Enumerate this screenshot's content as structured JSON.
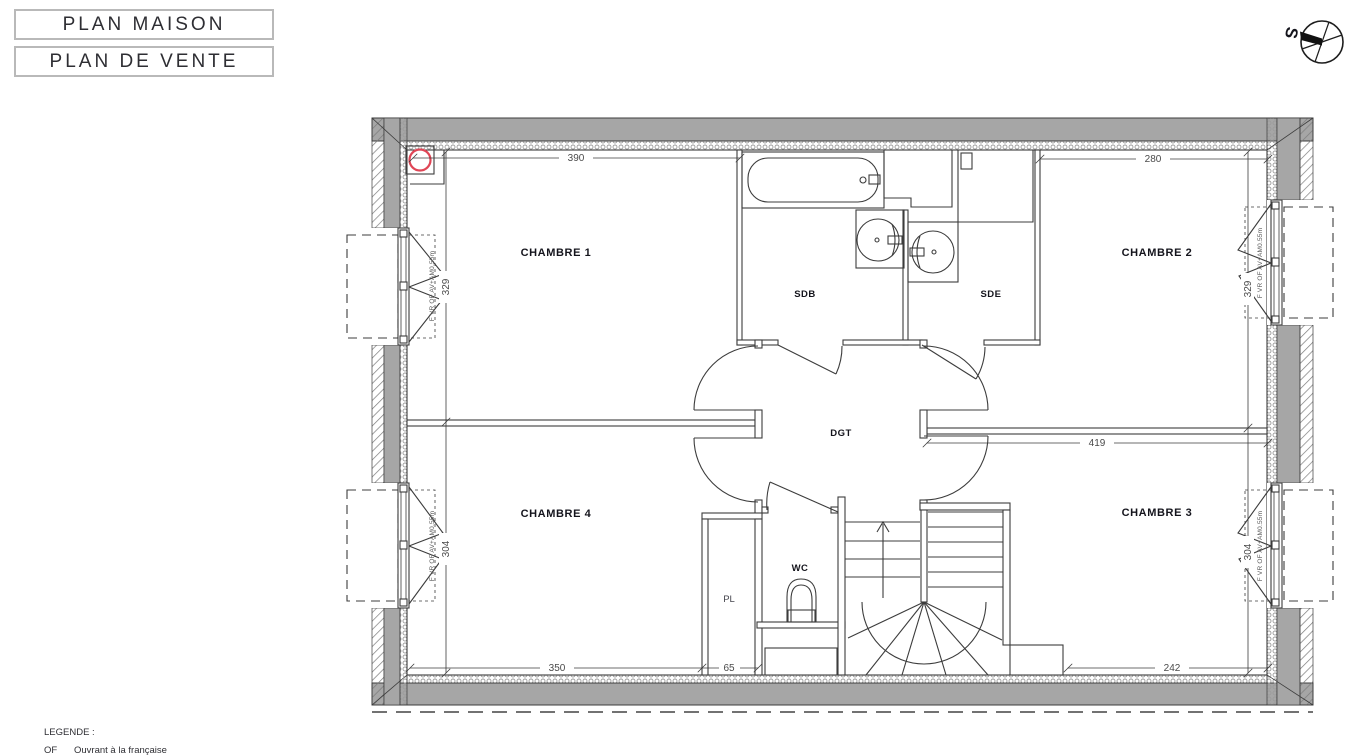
{
  "titles": {
    "primary": "PLAN MAISON",
    "secondary": "PLAN DE VENTE"
  },
  "compass": {
    "south_label": "S"
  },
  "legend": {
    "heading": "LEGENDE :",
    "items": [
      {
        "abbr": "OF",
        "label": "Ouvrant à la française"
      }
    ]
  },
  "rooms": {
    "chambre1": "CHAMBRE 1",
    "chambre2": "CHAMBRE 2",
    "chambre3": "CHAMBRE 3",
    "chambre4": "CHAMBRE 4",
    "sdb": "SDB",
    "sde": "SDE",
    "dgt": "DGT",
    "wc": "WC",
    "pl": "PL"
  },
  "dimensions": {
    "chambre1_width": "390",
    "chambre2_width": "280",
    "chambre1_height": "329",
    "chambre2_height": "329",
    "chambre4_height": "304",
    "chambre3_height": "304",
    "chambre3_width": "419",
    "chambre4_width": "350",
    "pl_width": "65",
    "chambre3_bottom_width": "242"
  },
  "windows": {
    "note": "F VR OF AV+AM0.55m"
  },
  "colors": {
    "wall_gray": "#a6a6a6",
    "accent_red": "#e04656"
  }
}
